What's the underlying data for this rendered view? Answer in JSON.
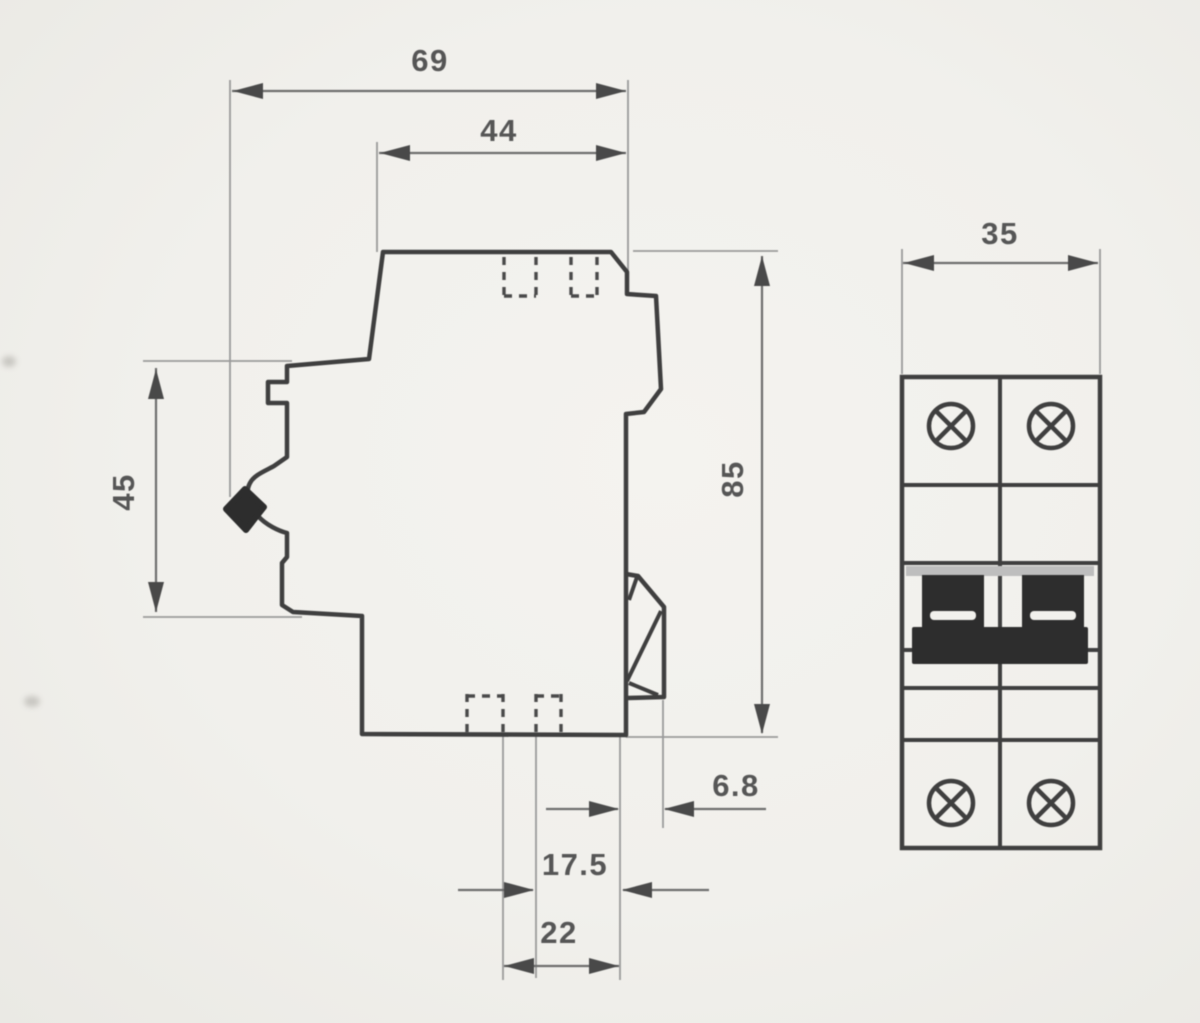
{
  "drawing": {
    "kind": "dimensioned-two-view-drawing",
    "colors": {
      "paper": "#f1f0ec",
      "outline_ink": "#404040",
      "dimension_ink": "#6e6e6e",
      "solid_fill": "#2e2e2e",
      "shade_gray": "#bdbdbd"
    },
    "dimensions": {
      "overall_depth": "69",
      "upper_depth": "44",
      "front_height": "45",
      "overall_height": "85",
      "clip_offset": "6.8",
      "terminal_inset": "17.5",
      "base_depth": "22",
      "pole_width": "35"
    }
  }
}
